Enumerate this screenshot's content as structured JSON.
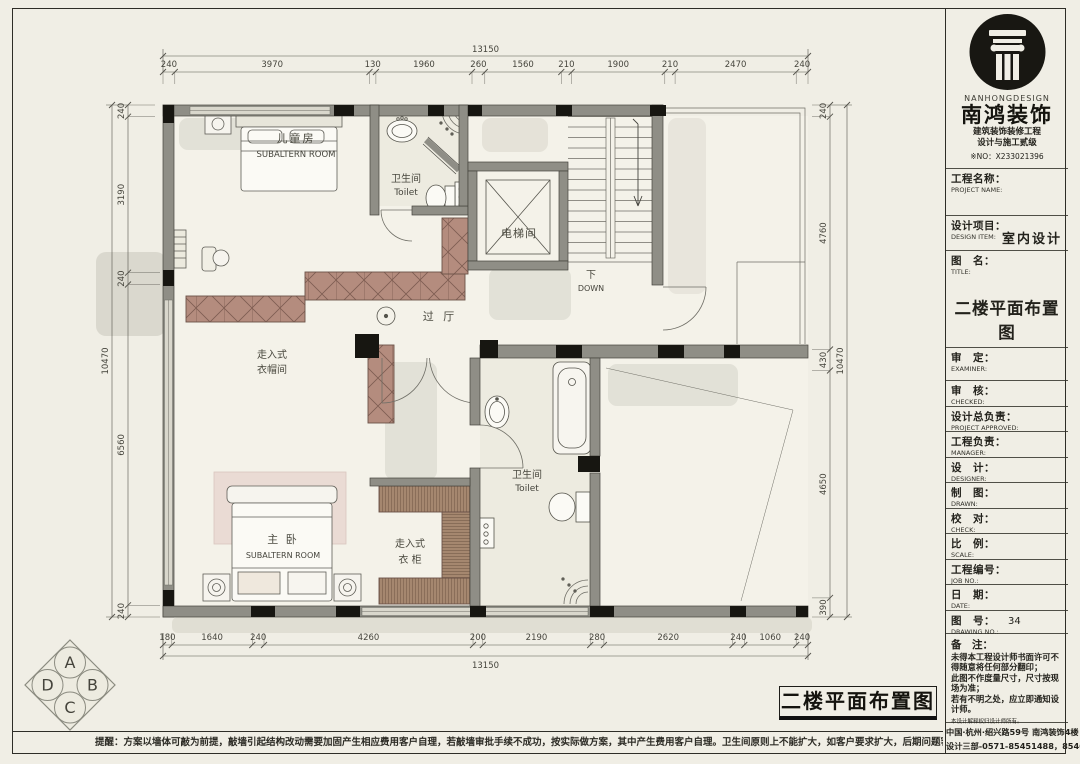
{
  "sheet": {
    "bg": "#f0eee5",
    "wall_color": "#8f8e86",
    "hatch_color": "#b48c7e"
  },
  "dimensions": {
    "top": {
      "total": "13150",
      "segments": [
        "240",
        "3970",
        "130",
        "1960",
        "260",
        "1560",
        "210",
        "1900",
        "210",
        "2470",
        "240"
      ]
    },
    "bottom": {
      "total": "13150",
      "segments": [
        "180",
        "1640",
        "240",
        "4260",
        "200",
        "2190",
        "280",
        "2620",
        "240",
        "1060",
        "240"
      ]
    },
    "left": {
      "total": "10470",
      "segments": [
        "240",
        "3190",
        "240",
        "6560",
        "240"
      ]
    },
    "right": {
      "total": "10470",
      "segments": [
        "240",
        "4760",
        "430",
        "4650",
        "390"
      ]
    }
  },
  "rooms": {
    "children": {
      "zh": "儿童房",
      "en": "SUBALTERN ROOM"
    },
    "toilet_top": {
      "zh": "卫生间",
      "en": "Toilet"
    },
    "elevator": {
      "zh": "电梯间"
    },
    "stairs": {
      "zh": "下",
      "en": "DOWN"
    },
    "hall": {
      "zh": "过 厅"
    },
    "cloakroom": {
      "line1": "走入式",
      "line2": "衣帽间"
    },
    "master": {
      "zh": "主 卧",
      "en": "SUBALTERN ROOM"
    },
    "closet": {
      "line1": "走入式",
      "line2": "衣 柜"
    },
    "toilet_master": {
      "zh": "卫生间",
      "en": "Toilet"
    }
  },
  "compass": {
    "n": "A",
    "e": "B",
    "s": "C",
    "w": "D"
  },
  "titleblock": {
    "brand": {
      "en": "NANHONGDESIGN",
      "zh": "南鸿装饰",
      "cert1": "建筑装饰装修工程",
      "cert2": "设计与施工贰级",
      "no": "※NO：X233021396"
    },
    "rows": [
      {
        "zh": "工程名称：",
        "en": "PROJECT NAME:"
      },
      {
        "zh": "设计项目：",
        "en": "DESIGN ITEM:",
        "value": "室内设计"
      },
      {
        "zh": "图　名：",
        "en": "TITLE:",
        "value": "二楼平面布置图"
      },
      {
        "zh": "审　定：",
        "en": "EXAMINER:"
      },
      {
        "zh": "审　核：",
        "en": "CHECKED:"
      },
      {
        "zh": "设计总负责：",
        "en": "PROJECT APPROVED:"
      },
      {
        "zh": "工程负责：",
        "en": "MANAGER:"
      },
      {
        "zh": "设　计：",
        "en": "DESIGNER:"
      },
      {
        "zh": "制　图：",
        "en": "DRAWN:"
      },
      {
        "zh": "校　对：",
        "en": "CHECK:"
      },
      {
        "zh": "比　例：",
        "en": "SCALE:"
      },
      {
        "zh": "工程编号：",
        "en": "JOB NO.:"
      },
      {
        "zh": "日　期：",
        "en": "DATE:"
      },
      {
        "zh": "图　号：",
        "en": "DRAWING NO.:",
        "value": "34"
      }
    ],
    "notes": {
      "zh": "备　注：",
      "lines": [
        "未得本工程设计师书面许可不得随意将任何部分翻印；",
        "此图不作度量尺寸，尺寸按现场为准；",
        "若有不明之处，应立即通知设计师。"
      ],
      "small": "本设计解释权归设计师所有。"
    },
    "address": {
      "line1": "中国·杭州·绍兴路59号 南鸿装饰4楼",
      "line2": "设计三部-0571-85451488，85462450"
    }
  },
  "footer": {
    "plan_title": "二楼平面布置图",
    "reminder": "提醒：方案以墙体可敲为前提，敲墙引起结构改动需要加固产生相应费用客户自理，若敲墙审批手续不成功，按实际做方案，其中产生费用客户自理。卫生间原则上不能扩大，如客户要求扩大，后期问题客户自己承担责任。"
  }
}
